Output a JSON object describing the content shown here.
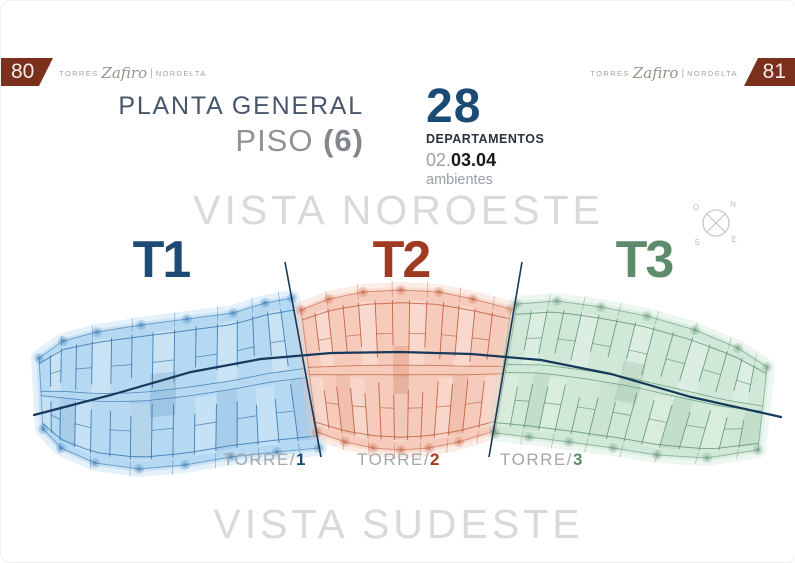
{
  "page": {
    "left_number": "80",
    "right_number": "81"
  },
  "brand": {
    "prefix": "TORRES",
    "name": "Zafiro",
    "separator": "|",
    "suffix": "NORDELTA"
  },
  "header": {
    "title": "PLANTA GENERAL",
    "subtitle_label": "PISO",
    "subtitle_value": "(6)"
  },
  "stats": {
    "count": "28",
    "count_label": "DEPARTAMENTOS",
    "rooms_light": "02.",
    "rooms_bold": "03.04",
    "rooms_label": "ambientes"
  },
  "views": {
    "northwest": "VISTA NOROESTE",
    "southeast": "VISTA SUDESTE"
  },
  "compass": {
    "north": "N",
    "west": "O",
    "south": "S",
    "east": "E"
  },
  "towers": [
    {
      "label": "T1",
      "torre_prefix": "TORRE/",
      "torre_number": "1",
      "color": "#1d4b76",
      "fill": "#a8d2f0",
      "wall": "#2f6ea8"
    },
    {
      "label": "T2",
      "torre_prefix": "TORRE/",
      "torre_number": "2",
      "color": "#a03a20",
      "fill": "#f6c2ae",
      "wall": "#bb5534"
    },
    {
      "label": "T3",
      "torre_prefix": "TORRE/",
      "torre_number": "3",
      "color": "#5d8b6c",
      "fill": "#c6e4d0",
      "wall": "#5d8f70"
    }
  ],
  "plan": {
    "line_color": "#16395c"
  }
}
